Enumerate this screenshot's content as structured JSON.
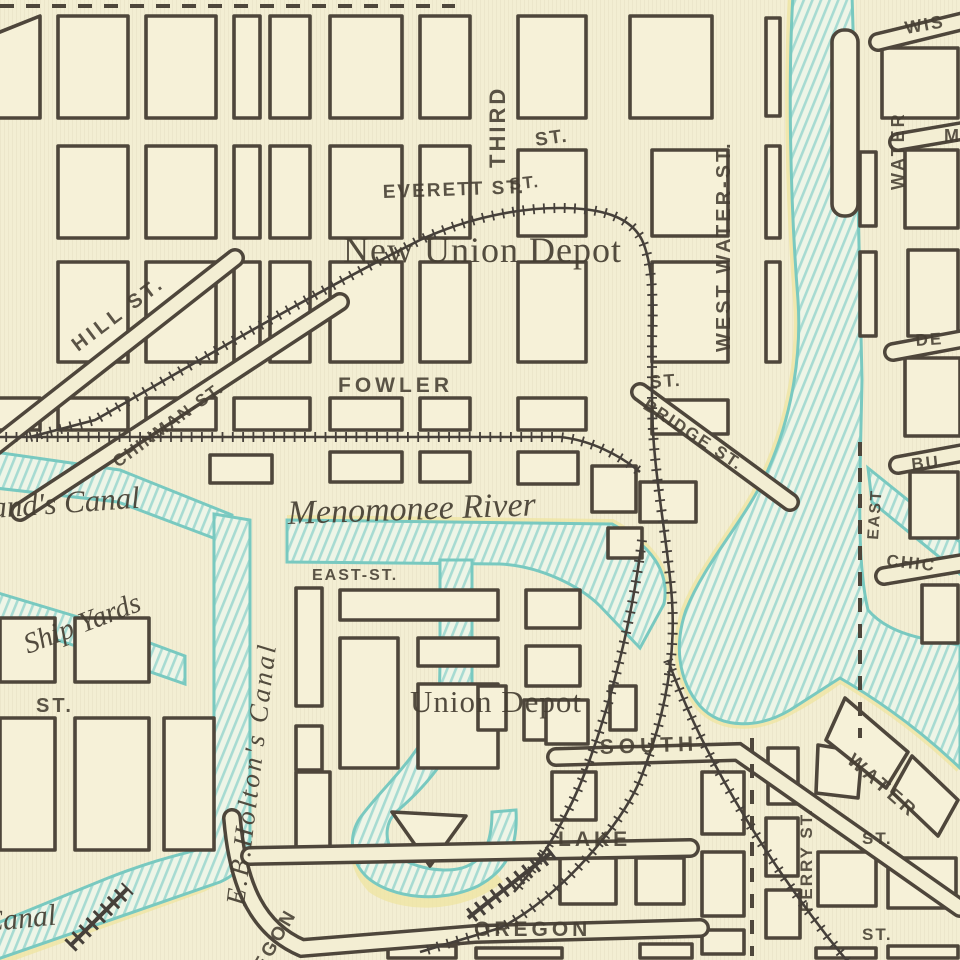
{
  "map": {
    "street_labels": {
      "third": "THIRD",
      "third_st": "ST.",
      "st_small": "ST.",
      "everett": "EVERETT ST.",
      "west_water": "WEST WATER-ST.",
      "hill": "HILL ST.",
      "chinman": "CHINMAN-ST.",
      "fowler": "FOWLER",
      "fowler_st": "ST.",
      "bridge": "BRIDGE ST.",
      "east_st": "EAST-ST.",
      "st_left": "ST.",
      "south": "SOUTH",
      "lake": "LAKE",
      "oregon": "OREGON",
      "oregon_curve": "OREGON",
      "ferry": "FERRY ST.",
      "water_south": "WATER",
      "st_se1": "ST.",
      "st_se2": "ST.",
      "wis": "WIS",
      "water_ne": "WATER",
      "m_ne": "M",
      "de": "DE",
      "bu": "BU",
      "east_vert": "EAST",
      "chic": "CHIC"
    },
    "place_labels": {
      "new_union_depot": "New Union Depot",
      "union_depot": "Union Depot",
      "ship_yards": "Ship Yards"
    },
    "water_labels": {
      "ands_canal": "and's Canal",
      "menomonee": "Menomonee River",
      "holtons": "E.B.Holton's Canal",
      "canal_sw": "Canal"
    },
    "colors": {
      "paper": "#f3eed3",
      "ink": "#4e463b",
      "water_stripe": "#a7dbd2",
      "water_shore": "#79c9c0",
      "yellow_halo": "#efe4a0"
    }
  }
}
